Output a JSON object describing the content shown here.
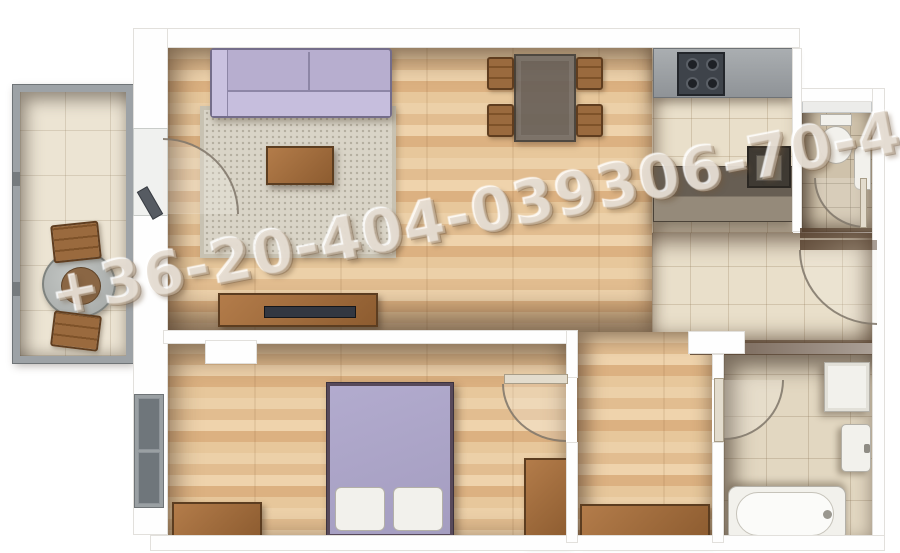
{
  "watermark": {
    "text": "+36-20-404-039306-70-44"
  },
  "colors": {
    "wood": "#e6c094",
    "tile": "#e9dfca",
    "wcFloor": "#cfc2ab",
    "bathFloor": "#e2d7c1",
    "balconyFloor": "#ece4d3",
    "sofa": "#b7aecf",
    "bed": "#aba4c6",
    "rug": "#d9d4c7",
    "furnitureWood": "#a9713f",
    "counter": "#9ba0a4",
    "appliance": "#3e434a",
    "fixture": "#f2f1ec",
    "railing": "#8b9094",
    "watermarkColor": "rgba(213,199,181,0.5)"
  }
}
